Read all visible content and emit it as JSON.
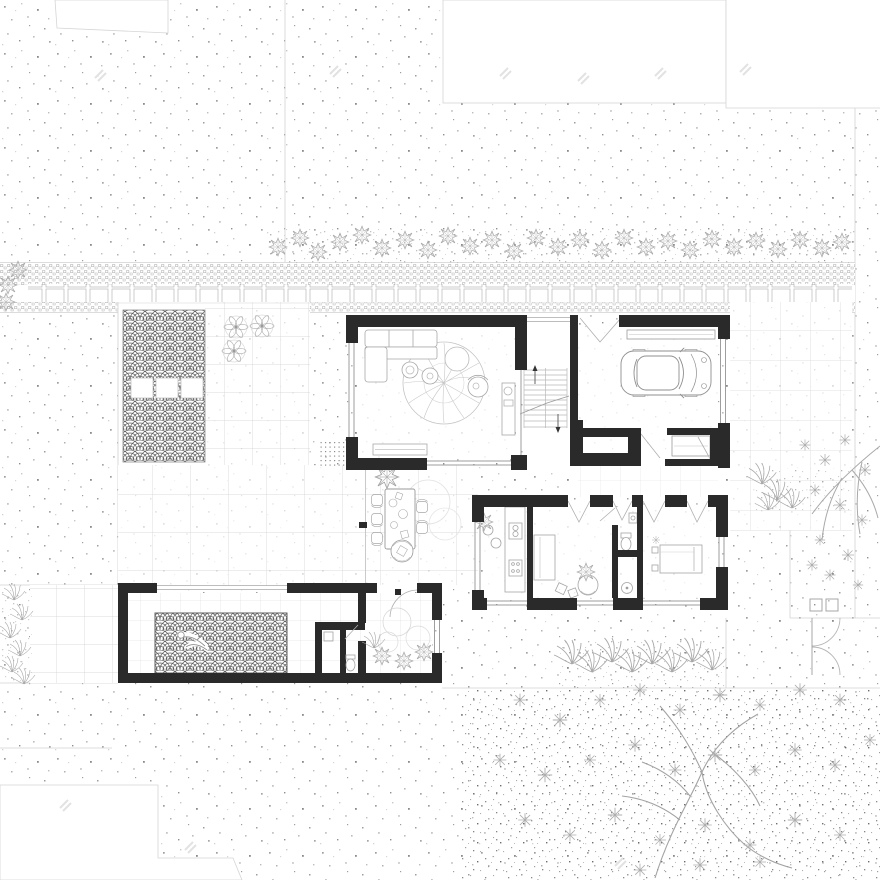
{
  "document": {
    "kind": "architectural ground-floor site plan, top-down view",
    "style": "black poche walls, stippled gravel ground, line-art vegetation, seigaiha wave paving"
  },
  "palette": {
    "background": "#ffffff",
    "wall": "#2a2a2a",
    "furniture_line": "#9a9a9a",
    "grid_line": "#cccccc",
    "boundary_line": "#d2d2d2",
    "pattern_line": "#5a5a5a",
    "vegetation_line": "#a0a0a0",
    "stipple": "#9e9e9e"
  },
  "watermark": {
    "text_legible": false,
    "mark_count": 9
  },
  "street": {
    "paving": "cobble strip with row of square stepping pavers",
    "hedge_row_bushes": 27
  },
  "house": {
    "rooms": [
      {
        "name": "living room",
        "furniture": [
          "L-shaped sofa",
          "round leaf-pattern rug",
          "2 round side tables",
          "round pouf",
          "armchair",
          "wall console",
          "low bench"
        ]
      },
      {
        "name": "entry + staircase",
        "features": [
          "stair treads",
          "up arrow",
          "down arrow",
          "break line"
        ]
      },
      {
        "name": "garage",
        "furniture": [
          "car (plan view)",
          "wall shelf"
        ]
      },
      {
        "name": "storage closet",
        "furniture": [
          "shelving"
        ]
      },
      {
        "name": "kitchen",
        "furniture": [
          "counter with sink and cooktop",
          "2 round stools",
          "plant"
        ]
      },
      {
        "name": "family room",
        "furniture": [
          "daybed",
          "wicker chair",
          "floor cushions"
        ]
      },
      {
        "name": "bathroom",
        "furniture": [
          "toilet",
          "washbasin",
          "shower with round drain"
        ]
      },
      {
        "name": "bedroom",
        "furniture": [
          "double bed with pillows",
          "bedside table"
        ]
      }
    ]
  },
  "courtyard": {
    "dining_table": 1,
    "dining_chairs": 5,
    "wicker_chair": 1,
    "doormat": 1,
    "plan_trees": 3,
    "sun_loungers": 3,
    "fan_pattern_patio": "seigaiha scales"
  },
  "pool_area": {
    "pool_pattern": "seigaiha waves",
    "swimmer_figures": 1,
    "bath_block": [
      "toilet",
      "washbasin"
    ],
    "patio_plants": 4
  },
  "landscape": {
    "large_tree_bottom_right": 1,
    "tree_right_edge": 1,
    "fern_clusters": 4,
    "right_fence_gate": "double swing gate",
    "blank_parcels": 4
  }
}
